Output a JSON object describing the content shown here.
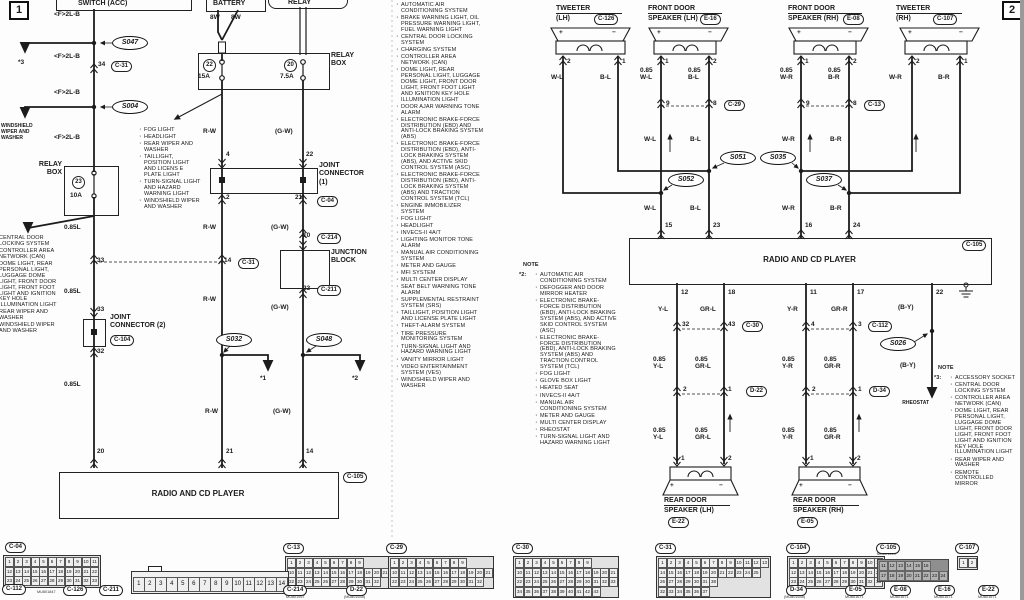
{
  "markers": {
    "p1": "1",
    "p2": "2"
  },
  "shared": {
    "radio": "RADIO AND CD PLAYER",
    "note": "NOTE"
  },
  "p1": {
    "switch": "SWITCH (ACC)",
    "battery": "BATTERY",
    "relay": "RELAY",
    "w8": "8W",
    "f2lb": "<F>2L-B",
    "s047": "S047",
    "s004": "S004",
    "s032": "S032",
    "s048": "S048",
    "star1": "*1",
    "star2": "*2",
    "star3": "*3",
    "windshield": "WINDSHIELD\nWIPER AND\nWASHER",
    "relay_box": "RELAY\nBOX",
    "fuse23": "23",
    "fuse23_amp": "10A",
    "fuse22": "22",
    "fuse22_amp": "15A",
    "fuse20": "20",
    "fuse20_amp": "7.5A",
    "l085": "0.85L",
    "rw": "R-W",
    "gw": "(G-W)",
    "jc1": "JOINT\nCONNECTOR\n(1)",
    "jc2": "JOINT\nCONNECTOR (2)",
    "junction_block": "JUNCTION\nBLOCK",
    "pins": {
      "p34": "34",
      "p33": "33",
      "p32": "32",
      "p20": "20",
      "p4": "4",
      "p2": "2",
      "p21": "21",
      "p22": "22",
      "p10": "10",
      "p23": "23",
      "p14": "14"
    },
    "codes": {
      "c31": "C-31",
      "c04": "C-04",
      "c214": "C-214",
      "c211": "C-211",
      "c104": "C-104",
      "c105": "C-105"
    },
    "partial_top": "CONTROL SYSTEM",
    "left_systems": [
      "CENTRAL DOOR LOCKING SYSTEM",
      "CONTROLLER AREA NETWORK (CAN)",
      "DOME LIGHT, REAR PERSONAL LIGHT, LUGGAGE DOME LIGHT,  FRONT DOOR LIGHT, FRONT FOOT LIGHT AND IGNITION KEY HOLE ILLUMINATION LIGHT",
      "REAR WIPER AND WASHER",
      "WINDSHIELD WIPER AND WASHER"
    ],
    "fog_systems": [
      "FOG LIGHT",
      "HEADLIGHT",
      "REAR WIPER AND WASHER",
      "TAILLIGHT, POSITION LIGHT AND LICENS E PLATE LIGHT",
      "TURN-SIGNAL LIGHT AND HAZARD WARNING LIGHT",
      "WINDSHIELD WIPER AND WASHER"
    ],
    "systems": [
      "AUTOMATIC AIR CONDITIONING SYSTEM",
      "BRAKE WARNING LIGHT, OIL PRESSURE WARNING LIGHT, FUEL WARNING LIGHT",
      "CENTRAL DOOR LOCKING SYSTEM",
      "CHARGING SYSTEM",
      "CONTROLLER AREA NETWORK (CAN)",
      "DOME LIGHT, REAR PERSONAL LIGHT, LUGGAGE DOME LIGHT, FRONT DOOR LIGHT, FRONT FOOT LIGHT AND IGNITION KEY HOLE ILLUMINATION LIGHT",
      "DOOR AJAR WARNING TONE ALARM",
      "ELECTRONIC BRAKE-FORCE DISTRIBUTION (EBD) AND ANTI-LOCK BRAKING SYSTEM (ABS)",
      "ELECTRONIC BRAKE-FORCE DISTRIBUTION (EBD), ANTI-LOCK BRAKING SYSTEM (ABS), AND ACTIVE SKID CONTROL SYSTEM (ASC)",
      "ELECTRONIC BRAKE-FORCE DISTRIBUTION (EBD), ANTI-LOCK BRAKING SYSTEM (ABS) AND TRACTION CONTROL SYSTEM (TCL)",
      "ENGINE IMMOBILIZER SYSTEM",
      "FOG LIGHT",
      "HEADLIGHT",
      "INVECS-II 4A/T",
      "LIGHTING MONITOR TONE ALARM",
      "MANUAL AIR CONDITIONING SYSTEM",
      "METER AND GAUGE",
      "MFI SYSTEM",
      "MULTI CENTER DISPLAY",
      "SEAT BELT WARNING TONE ALARM",
      "SUPPLEMENTAL RESTRAINT SYSTEM (SRS)",
      "TAILLIGHT, POSITION LIGHT AND LICENSE PLATE LIGHT",
      "THEFT-ALARM SYSTEM",
      "TIRE PRESSURE MONITORING SYSTEM",
      "TURN-SIGNAL LIGHT AND HAZARD WARNING LIGHT",
      "VANITY MIRROR LIGHT",
      "VIDEO ENTERTAINMENT SYSTEM (VES)",
      "WINDSHIELD WIPER AND WASHER"
    ]
  },
  "note2": {
    "tag": "*2:",
    "items": [
      "AUTOMATIC AIR CONDITIONING SYSTEM",
      "DEFOGGER AND DOOR MIRROR HEATER",
      "ELECTRONIC BRAKE-FORCE DISTRIBUTION (EBD), ANTI-LOCK BRAKING SYSTEM (ABS), AND ACTIVE SKID CONTROL SYSTEM (ASC)",
      "ELECTRONIC BRAKE-FORCE DISTRIBUTION (EBD), ANTI-LOCK BRAKING SYSTEM (ABS) AND TRACTION CONTROL SYSTEM (TCL)",
      "FOG LIGHT",
      "GLOVE BOX LIGHT",
      "HEATED SEAT",
      "INVECS-II 4A/T",
      "MANUAL AIR CONDITIONING SYSTEM",
      "METER AND GAUGE",
      "MULTI CENTER DISPLAY",
      "RHEOSTAT",
      "TURN-SIGNAL LIGHT AND HAZARD WARNING LIGHT"
    ]
  },
  "note3": {
    "tag": "*3:",
    "items": [
      "ACCESSORY SOCKET",
      "CENTRAL DOOR LOCKING SYSTEM",
      "CONTROLLER AREA NETWORK (CAN)",
      "DOME LIGHT, REAR PERSONAL LIGHT, LUGGAGE DOME LIGHT, FRONT DOOR LIGHT, FRONT FOOT LIGHT AND IGNITION KEY HOLE ILLUMINATION LIGHT",
      "REAR WIPER AND WASHER",
      "REMOTE CONTROLLED MIRROR"
    ]
  },
  "p2": {
    "tw_lh": {
      "l1": "TWEETER",
      "l2": "(LH)",
      "code": "C-126",
      "pa": "2",
      "pb": "1"
    },
    "fds_lh": {
      "l1": "FRONT DOOR",
      "l2": "SPEAKER (LH)",
      "code": "E-16",
      "pa": "1",
      "pb": "2",
      "wa": "0.85\nW-L",
      "wb": "0.85\nB-L"
    },
    "fds_rh": {
      "l1": "FRONT DOOR",
      "l2": "SPEAKER (RH)",
      "code": "E-08",
      "pa": "1",
      "pb": "2",
      "wa": "0.85\nW-R",
      "wb": "0.85\nB-R"
    },
    "tw_rh": {
      "l1": "TWEETER",
      "l2": "(RH)",
      "code": "C-107",
      "pa": "2",
      "pb": "1"
    },
    "rds_lh": {
      "l1": "REAR DOOR",
      "l2": "SPEAKER (LH)",
      "code": "E-22",
      "pa": "1",
      "pb": "2"
    },
    "rds_rh": {
      "l1": "REAR DOOR",
      "l2": "SPEAKER (RH)",
      "code": "E-05",
      "pa": "1",
      "pb": "2"
    },
    "wl": "W-L",
    "bl": "B-L",
    "wr": "W-R",
    "br": "B-R",
    "yl": "Y-L",
    "grl": "GR-L",
    "yr": "Y-R",
    "grr": "GR-R",
    "by": "(B-Y)",
    "w085": {
      "yl": "0.85\nY-L",
      "grl": "0.85\nGR-L",
      "yr": "0.85\nY-R",
      "grr": "0.85\nGR-R"
    },
    "splices": {
      "s051": "S051",
      "s052": "S052",
      "s035": "S035",
      "s037": "S037",
      "s026": "S026"
    },
    "cross": {
      "c29": {
        "a": "9",
        "b": "8",
        "code": "C-29"
      },
      "c13": {
        "a": "9",
        "b": "8",
        "code": "C-13"
      },
      "c30": {
        "a": "32",
        "b": "43",
        "code": "C-30"
      },
      "c112": {
        "a": "4",
        "b": "3",
        "code": "C-112"
      },
      "d22": {
        "a": "2",
        "b": "1",
        "code": "D-22"
      },
      "d34": {
        "a": "2",
        "b": "1",
        "code": "D-34"
      }
    },
    "rpins": {
      "p15": "15",
      "p23": "23",
      "p16": "16",
      "p24": "24",
      "p12": "12",
      "p18": "18",
      "p11": "11",
      "p17": "17",
      "p22": "22"
    },
    "plus": "+",
    "minus": "−",
    "rheostat": "RHEOSTAT",
    "c105": "C-105"
  },
  "connectors": {
    "c04": {
      "code": "C-04",
      "rows": [
        "1 2 3 4 5 6 7 8 9 10 11",
        "12 13 14 15 16 17 18 19 20 21 22",
        "23 24 25 26 27 28 29 30 31 32 33"
      ]
    },
    "c13": {
      "code": "C-13",
      "rows": [
        "1 2 3 4 5 6 7 8 9",
        "10 11 12 13 14 15 16 17 18 19 20 21",
        "22 23 24 25 26 27 28 29 30 31 32"
      ]
    },
    "c29": {
      "code": "C-29",
      "rows": [
        "1 2 3 4 5 6 7 8 9",
        "10 11 12 13 14 15 16 17 18 19 20 21",
        "22 23 24 25 26 27 28 29 30 31 32"
      ]
    },
    "c30": {
      "code": "C-30",
      "rows": [
        "1 2 3 4 5 6 7 8 9",
        "10 11 12 13 14 15 16 17 18 19 20 21",
        "22 23 24 25 26 27 28 29 30 31 32 33",
        "34 35 36 37 38 39 40 41 42 43"
      ]
    },
    "c31": {
      "code": "C-31",
      "rows": [
        "1 2 3 4 5 6 7 8 9 10 11 12 13",
        "14 15 16 17 18 19 20 21 22 23 24 25",
        "26 27 28 29 30 31 38",
        "32 33 34 35 36 37"
      ]
    },
    "c104": {
      "code": "C-104",
      "rows": [
        "1 2 3 4 5 6 7 8 9 10 11",
        "12 13 14 15 16 17 18 19 20 21 22",
        "23 24 25 26 27 28 29 30 31 32 33"
      ]
    },
    "c105": {
      "code": "C-105",
      "part": "MU801453",
      "rows": [
        "11 12 13 14 15 16",
        "17 18 19 20 21 22 23 24"
      ]
    },
    "c107": {
      "code": "C-107",
      "rows": [
        "1 2"
      ]
    },
    "c112": {
      "code": "C-112",
      "part": "MU801847"
    },
    "c126": {
      "code": "C-126"
    },
    "c211": {
      "code": "C-211",
      "rows": [
        "1 2 3 4 5 6 7 8 9 10 11 12 13 14"
      ]
    },
    "c214": {
      "code": "C-214",
      "part": "MU801957"
    },
    "d22": {
      "code": "D-22",
      "part": "(MU801645)"
    },
    "d34": {
      "code": "D-34",
      "part": "(MU801645)"
    },
    "e05": {
      "code": "E-05",
      "part": "MU801671"
    },
    "e08": {
      "code": "E-08",
      "part": "MU801671"
    },
    "e16": {
      "code": "E-16",
      "part": "MU801671"
    },
    "e22": {
      "code": "E-22",
      "part": "MU801671"
    }
  }
}
